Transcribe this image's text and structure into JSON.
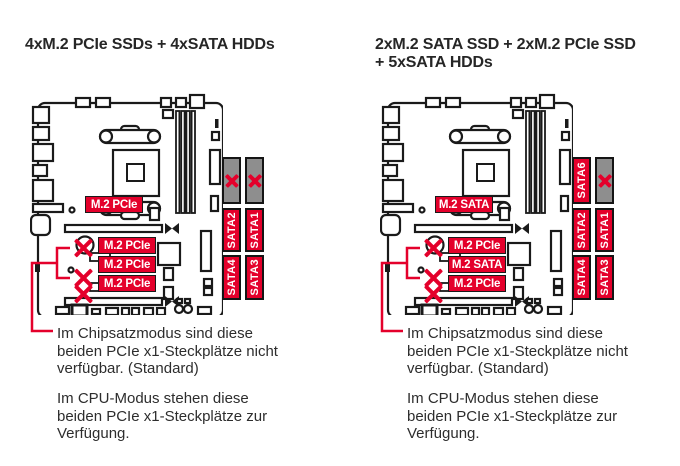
{
  "colors": {
    "red": "#e4002b",
    "gray": "#8e8e8e",
    "line": "#1a1a1a",
    "text": "#2d2d2d"
  },
  "panels": [
    {
      "title_lines": [
        "4xM.2 PCIe SSDs + 4xSATA HDDs"
      ],
      "m2_slots": [
        {
          "label": "M.2 PCIe"
        },
        {
          "label": "M.2 PCIe"
        },
        {
          "label": "M.2 PCIe"
        },
        {
          "label": "M.2 PCIe"
        }
      ],
      "sata_ports": [
        {
          "label": "",
          "disabled": true
        },
        {
          "label": "",
          "disabled": true
        },
        {
          "label": "SATA2",
          "disabled": false
        },
        {
          "label": "SATA1",
          "disabled": false
        },
        {
          "label": "SATA4",
          "disabled": false
        },
        {
          "label": "SATA3",
          "disabled": false
        }
      ],
      "notes": [
        {
          "lines": [
            "Im Chipsatzmodus sind diese",
            "beiden PCIe x1-Steckplätze nicht",
            "verfügbar. (Standard)"
          ]
        },
        {
          "lines": [
            "Im CPU-Modus stehen diese",
            "beiden PCIe x1-Steckplätze zur",
            "Verfügung."
          ]
        }
      ]
    },
    {
      "title_lines": [
        "2xM.2 SATA SSD + 2xM.2 PCIe SSD",
        "+ 5xSATA HDDs"
      ],
      "m2_slots": [
        {
          "label": "M.2 SATA"
        },
        {
          "label": "M.2 PCIe"
        },
        {
          "label": "M.2 SATA"
        },
        {
          "label": "M.2 PCIe"
        }
      ],
      "sata_ports": [
        {
          "label": "SATA6",
          "disabled": false
        },
        {
          "label": "",
          "disabled": true
        },
        {
          "label": "SATA2",
          "disabled": false
        },
        {
          "label": "SATA1",
          "disabled": false
        },
        {
          "label": "SATA4",
          "disabled": false
        },
        {
          "label": "SATA3",
          "disabled": false
        }
      ],
      "notes": [
        {
          "lines": [
            "Im Chipsatzmodus sind diese",
            "beiden PCIe x1-Steckplätze nicht",
            "verfügbar. (Standard)"
          ]
        },
        {
          "lines": [
            "Im CPU-Modus stehen diese",
            "beiden PCIe x1-Steckplätze zur",
            "Verfügung."
          ]
        }
      ]
    }
  ]
}
